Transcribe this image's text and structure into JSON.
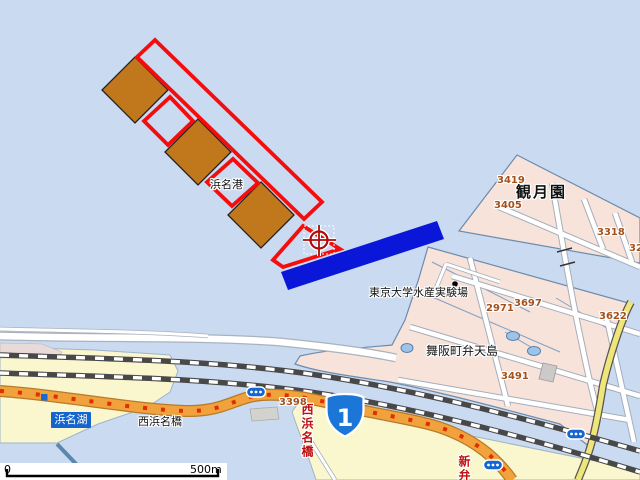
{
  "map": {
    "labels": {
      "port": "浜名港",
      "garden": "観月園",
      "experiment_station": "東京大学水産実験場",
      "island": "舞阪町弁天島",
      "lake": "浜名湖",
      "bridge_black": "西浜名橋",
      "bridge_red_vertical": "西浜名橋",
      "shinben_vertical": "新弁"
    },
    "parcel_numbers": [
      "3419",
      "3405",
      "3318",
      "32",
      "2971",
      "3697",
      "3622",
      "3491",
      "3398"
    ],
    "route_shield": {
      "number": "1"
    },
    "scale_bar": {
      "start_label": "0",
      "end_label": "500m"
    },
    "colors": {
      "water": "#CADAF1",
      "land_pink": "#F8E3DB",
      "land_yellow": "#FAF7CF",
      "pier_brown": "#C1771B",
      "selection_red": "#F50D0D",
      "breakwater_blue": "#0A16D8",
      "road_orange": "#F2A23C",
      "road_yellow": "#EFE67A",
      "rail_dark": "#484848",
      "parcel_text": "#A3511C",
      "red_text": "#BE1010",
      "sign_blue": "#1565CE"
    }
  }
}
